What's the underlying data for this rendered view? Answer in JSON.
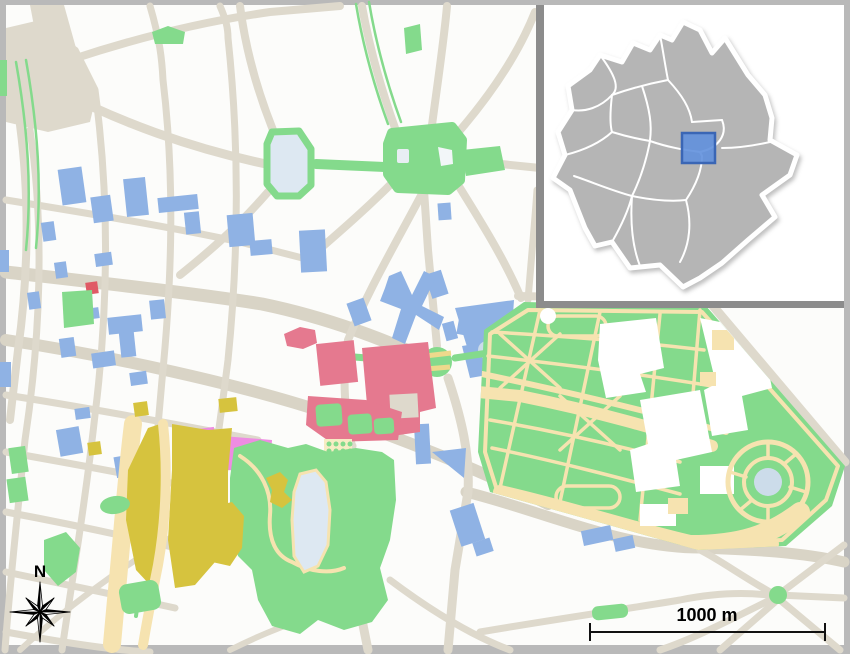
{
  "canvas": {
    "width": 850,
    "height": 654
  },
  "compass": {
    "label": "N"
  },
  "scale_bar": {
    "label": "1000 m"
  },
  "inset": {
    "highlight_shape": "rectangle"
  },
  "colors": {
    "frame": "#b9b9b9",
    "map_background": "#fcfcfa",
    "street": "#ded9cc",
    "street_major": "#d9d4c6",
    "park_green": "#84da8c",
    "path_cream": "#f6e3b0",
    "stripe_yellow": "#eed98c",
    "pond_blue": "#ccdcea",
    "pond_light": "#dde8f2",
    "building_blue": "#8fb2e4",
    "building_pink": "#e5798f",
    "building_magenta": "#ee8ce2",
    "building_red": "#e05a66",
    "railway_yellow": "#d6c33e",
    "plaza_dot_bg": "#f7ecc4",
    "inset_background": "#ffffff",
    "inset_frame": "#8c8c8c",
    "municipality_gray": "#b5b5b5",
    "municipality_border": "#ffffff",
    "highlight_fill": "#6090dd",
    "highlight_stroke": "#3a66b5",
    "text": "#000000"
  }
}
